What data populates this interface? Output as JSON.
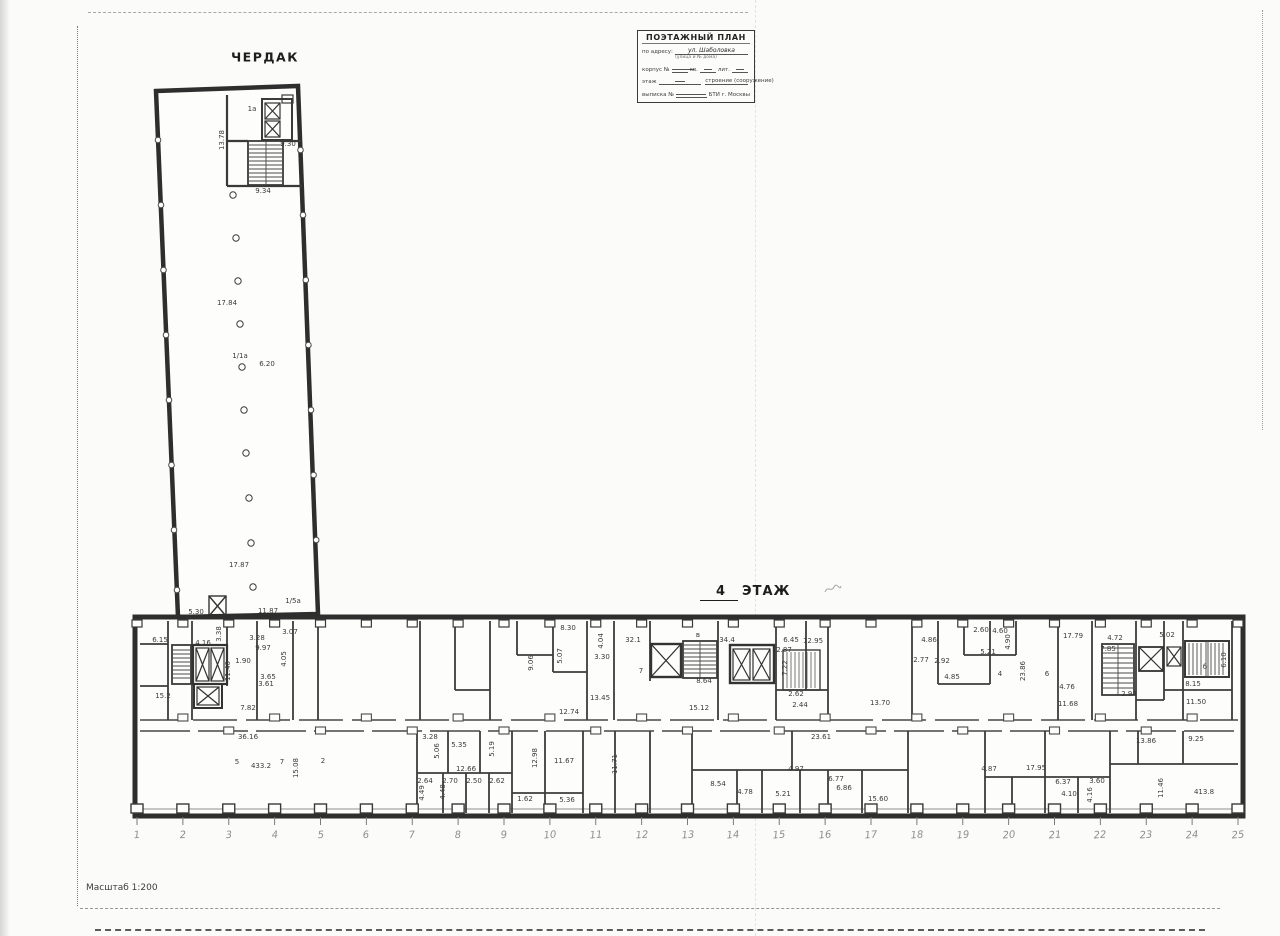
{
  "page": {
    "attic_label": "ЧЕРДАК",
    "floor_label_number": "4",
    "floor_label_text": "ЭТАЖ",
    "scale_label": "Масштаб 1:200"
  },
  "stamp": {
    "title": "ПОЭТАЖНЫЙ ПЛАН",
    "line1_label": "по адресу:",
    "line1_value": "ул. Шаболовка",
    "line1_sub": "(улица и № дома)",
    "line2_label": "корпус №",
    "line2_mid": "кв.",
    "line2_end": "лит.",
    "line3_label": "этаж",
    "line3_mid": "строение (сооружение)",
    "line4_label": "выписка №",
    "line4_end": "БТИ г. Москвы"
  },
  "plan": {
    "grid_numbers": [
      "1",
      "2",
      "3",
      "4",
      "5",
      "6",
      "7",
      "8",
      "9",
      "10",
      "11",
      "12",
      "13",
      "14",
      "15",
      "16",
      "17",
      "18",
      "19",
      "20",
      "21",
      "22",
      "23",
      "24",
      "25"
    ],
    "labels": [
      {
        "x": 222,
        "y": 140,
        "t": "13.78",
        "v": true
      },
      {
        "x": 252,
        "y": 109,
        "t": "1а"
      },
      {
        "x": 288,
        "y": 144,
        "t": "9.30"
      },
      {
        "x": 263,
        "y": 191,
        "t": "9.34"
      },
      {
        "x": 227,
        "y": 303,
        "t": "17.84"
      },
      {
        "x": 267,
        "y": 364,
        "t": "6.20"
      },
      {
        "x": 240,
        "y": 356,
        "t": "1/1а"
      },
      {
        "x": 239,
        "y": 565,
        "t": "17.87"
      },
      {
        "x": 268,
        "y": 611,
        "t": "11.87"
      },
      {
        "x": 196,
        "y": 612,
        "t": "5.30"
      },
      {
        "x": 293,
        "y": 601,
        "t": "1/5а"
      },
      {
        "x": 160,
        "y": 640,
        "t": "6.15"
      },
      {
        "x": 203,
        "y": 643,
        "t": "4.16"
      },
      {
        "x": 219,
        "y": 634,
        "t": "3.38",
        "v": true
      },
      {
        "x": 257,
        "y": 638,
        "t": "3.28"
      },
      {
        "x": 263,
        "y": 648,
        "t": "9.97"
      },
      {
        "x": 243,
        "y": 661,
        "t": "1.90"
      },
      {
        "x": 284,
        "y": 659,
        "t": "4.05",
        "v": true
      },
      {
        "x": 268,
        "y": 677,
        "t": "3.65"
      },
      {
        "x": 266,
        "y": 684,
        "t": "3.61"
      },
      {
        "x": 290,
        "y": 632,
        "t": "3.07"
      },
      {
        "x": 228,
        "y": 671,
        "t": "11.40",
        "v": true
      },
      {
        "x": 248,
        "y": 708,
        "t": "7.82"
      },
      {
        "x": 163,
        "y": 696,
        "t": "15.2"
      },
      {
        "x": 531,
        "y": 663,
        "t": "9.06",
        "v": true
      },
      {
        "x": 560,
        "y": 656,
        "t": "5.07",
        "v": true
      },
      {
        "x": 568,
        "y": 628,
        "t": "8.30"
      },
      {
        "x": 601,
        "y": 641,
        "t": "4.04",
        "v": true
      },
      {
        "x": 602,
        "y": 657,
        "t": "3.30"
      },
      {
        "x": 633,
        "y": 640,
        "t": "32.1"
      },
      {
        "x": 641,
        "y": 671,
        "t": "7"
      },
      {
        "x": 698,
        "y": 635,
        "t": "в"
      },
      {
        "x": 704,
        "y": 681,
        "t": "8.64"
      },
      {
        "x": 727,
        "y": 640,
        "t": "34.4"
      },
      {
        "x": 699,
        "y": 708,
        "t": "15.12"
      },
      {
        "x": 784,
        "y": 650,
        "t": "2.87"
      },
      {
        "x": 791,
        "y": 640,
        "t": "6.45"
      },
      {
        "x": 785,
        "y": 668,
        "t": "7.22",
        "v": true
      },
      {
        "x": 800,
        "y": 705,
        "t": "2.44"
      },
      {
        "x": 796,
        "y": 694,
        "t": "2.62"
      },
      {
        "x": 813,
        "y": 641,
        "t": "12.95"
      },
      {
        "x": 880,
        "y": 703,
        "t": "13.70"
      },
      {
        "x": 921,
        "y": 660,
        "t": "2.77"
      },
      {
        "x": 942,
        "y": 661,
        "t": "2.92"
      },
      {
        "x": 952,
        "y": 677,
        "t": "4.85"
      },
      {
        "x": 981,
        "y": 630,
        "t": "2.60"
      },
      {
        "x": 1000,
        "y": 631,
        "t": "4.60"
      },
      {
        "x": 929,
        "y": 640,
        "t": "4.86"
      },
      {
        "x": 1008,
        "y": 642,
        "t": "4.90",
        "v": true
      },
      {
        "x": 988,
        "y": 652,
        "t": "5.21"
      },
      {
        "x": 1073,
        "y": 636,
        "t": "17.79"
      },
      {
        "x": 1023,
        "y": 671,
        "t": "23.86",
        "v": true
      },
      {
        "x": 1000,
        "y": 674,
        "t": "4"
      },
      {
        "x": 1047,
        "y": 674,
        "t": "6"
      },
      {
        "x": 1067,
        "y": 687,
        "t": "4.76"
      },
      {
        "x": 1068,
        "y": 704,
        "t": "11.68"
      },
      {
        "x": 1115,
        "y": 638,
        "t": "4.72"
      },
      {
        "x": 1108,
        "y": 649,
        "t": "7.85"
      },
      {
        "x": 1167,
        "y": 635,
        "t": "5.02"
      },
      {
        "x": 1193,
        "y": 684,
        "t": "8.15"
      },
      {
        "x": 1196,
        "y": 702,
        "t": "11.50"
      },
      {
        "x": 1205,
        "y": 667,
        "t": "б"
      },
      {
        "x": 1129,
        "y": 694,
        "t": "2.94"
      },
      {
        "x": 1224,
        "y": 660,
        "t": "6.10",
        "v": true
      },
      {
        "x": 569,
        "y": 712,
        "t": "12.74"
      },
      {
        "x": 600,
        "y": 698,
        "t": "13.45"
      },
      {
        "x": 248,
        "y": 737,
        "t": "36.16"
      },
      {
        "x": 237,
        "y": 762,
        "t": "5"
      },
      {
        "x": 261,
        "y": 766,
        "t": "433.2"
      },
      {
        "x": 282,
        "y": 762,
        "t": "7"
      },
      {
        "x": 296,
        "y": 768,
        "t": "15.08",
        "v": true
      },
      {
        "x": 323,
        "y": 761,
        "t": "2"
      },
      {
        "x": 430,
        "y": 737,
        "t": "3.28"
      },
      {
        "x": 437,
        "y": 751,
        "t": "5.06",
        "v": true
      },
      {
        "x": 459,
        "y": 745,
        "t": "5.35"
      },
      {
        "x": 492,
        "y": 749,
        "t": "5.19",
        "v": true
      },
      {
        "x": 466,
        "y": 769,
        "t": "12.66"
      },
      {
        "x": 425,
        "y": 781,
        "t": "2.64"
      },
      {
        "x": 450,
        "y": 781,
        "t": "2.70"
      },
      {
        "x": 474,
        "y": 781,
        "t": "2.50"
      },
      {
        "x": 497,
        "y": 781,
        "t": "2.62"
      },
      {
        "x": 422,
        "y": 793,
        "t": "4.49",
        "v": true
      },
      {
        "x": 443,
        "y": 792,
        "t": "4.48",
        "v": true
      },
      {
        "x": 535,
        "y": 758,
        "t": "12.98",
        "v": true
      },
      {
        "x": 564,
        "y": 761,
        "t": "11.67"
      },
      {
        "x": 525,
        "y": 799,
        "t": "1.62"
      },
      {
        "x": 567,
        "y": 800,
        "t": "5.36"
      },
      {
        "x": 615,
        "y": 764,
        "t": "11.71",
        "v": true
      },
      {
        "x": 718,
        "y": 784,
        "t": "8.54"
      },
      {
        "x": 745,
        "y": 792,
        "t": "4.78"
      },
      {
        "x": 783,
        "y": 794,
        "t": "5.21"
      },
      {
        "x": 821,
        "y": 737,
        "t": "23.61"
      },
      {
        "x": 796,
        "y": 769,
        "t": "4.97"
      },
      {
        "x": 836,
        "y": 779,
        "t": "6.77"
      },
      {
        "x": 844,
        "y": 788,
        "t": "6.86"
      },
      {
        "x": 878,
        "y": 799,
        "t": "15.60"
      },
      {
        "x": 989,
        "y": 769,
        "t": "4.87"
      },
      {
        "x": 1036,
        "y": 768,
        "t": "17.95"
      },
      {
        "x": 1063,
        "y": 782,
        "t": "6.37"
      },
      {
        "x": 1097,
        "y": 781,
        "t": "3.60"
      },
      {
        "x": 1090,
        "y": 795,
        "t": "4.16",
        "v": true
      },
      {
        "x": 1069,
        "y": 794,
        "t": "4.10"
      },
      {
        "x": 1146,
        "y": 741,
        "t": "13.86"
      },
      {
        "x": 1161,
        "y": 788,
        "t": "11.46",
        "v": true
      },
      {
        "x": 1196,
        "y": 739,
        "t": "9.25"
      },
      {
        "x": 1204,
        "y": 792,
        "t": "413.8"
      }
    ]
  }
}
